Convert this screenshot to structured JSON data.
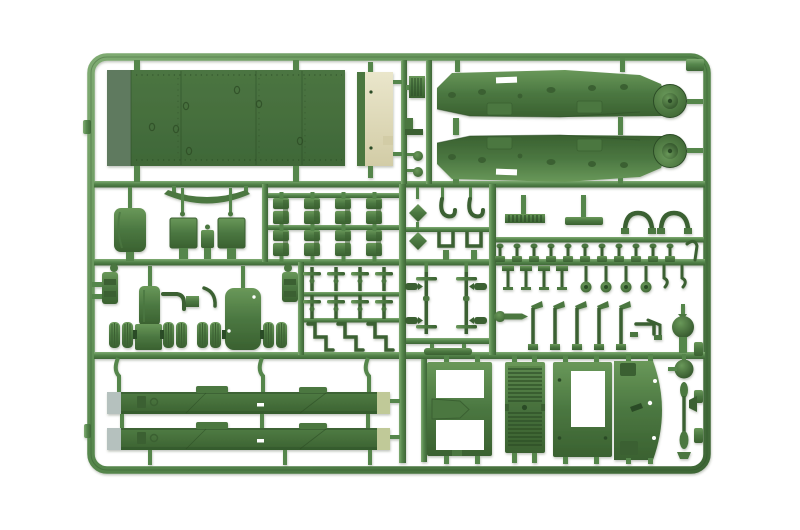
{
  "meta": {
    "description": "Photograph of a green injection-molded plastic model kit sprue with tank hull parts on a white background",
    "subject": "model-kit-sprue",
    "plastic_color_name": "olive green",
    "backdrop": "white seamless"
  },
  "colors": {
    "background": "#ffffff",
    "runner-light": "#7fab72",
    "runner-mid": "#55864c",
    "runner-dark": "#3e6636",
    "part-light": "#699859",
    "part-mid": "#4b7741",
    "part-dark": "#3a6130",
    "part-darker": "#2c4c25",
    "plate-light": "#4c7542",
    "plate-dark": "#3f6838",
    "plate-band": "#5e7a5e",
    "cream-light": "#eae6cb",
    "cream-dark": "#d2cca6",
    "beam-light": "#507c44",
    "beam-dark": "#3b6231",
    "beam-cap-left": "#b5c1be",
    "beam-cap-right": "#c0c998",
    "white-detail": "#ffffff"
  },
  "sprue": {
    "frame": {
      "x": 91,
      "y": 57,
      "width": 616,
      "height": 413,
      "corner_radius": 16
    },
    "sections": [
      {
        "id": "top-left",
        "label": "hull deck plate",
        "parts": [
          {
            "name": "large riveted deck plate"
          },
          {
            "name": "light unpigmented end strip"
          }
        ]
      },
      {
        "id": "top-right",
        "label": "fenders",
        "parts": [
          {
            "name": "track fender with round wheel housing",
            "count": 2
          },
          {
            "name": "small ribbed chip"
          },
          {
            "name": "l-bracket"
          },
          {
            "name": "round knob",
            "count": 2
          }
        ]
      },
      {
        "id": "middle-left",
        "label": "stowage fittings",
        "parts": [
          {
            "name": "curved leaf spring"
          },
          {
            "name": "rounded stowage box"
          },
          {
            "name": "square hatch plate",
            "count": 2
          },
          {
            "name": "small fitting"
          }
        ]
      },
      {
        "id": "bracket-grid",
        "label": "suspension brackets",
        "parts": [
          {
            "name": "small bracket",
            "count": 8
          }
        ]
      },
      {
        "id": "middle-center",
        "label": "clamps and hooks",
        "parts": [
          {
            "name": "diamond plate",
            "count": 2
          },
          {
            "name": "hook clamp",
            "count": 2
          },
          {
            "name": "u-bracket",
            "count": 2
          }
        ]
      },
      {
        "id": "middle-right",
        "label": "pins and handles",
        "parts": [
          {
            "name": "ribbed comb strip"
          },
          {
            "name": "flat bar"
          },
          {
            "name": "grab handle",
            "count": 2
          },
          {
            "name": "small pin",
            "count": 11
          },
          {
            "name": "bent pin"
          }
        ]
      },
      {
        "id": "suspension-band",
        "label": "running gear",
        "parts": [
          {
            "name": "wheel bogie assembly",
            "count": 2
          },
          {
            "name": "mounting bracket",
            "count": 2
          },
          {
            "name": "elbow pipe",
            "count": 2
          },
          {
            "name": "cross axle",
            "count": 8
          },
          {
            "name": "z-bracket",
            "count": 3
          },
          {
            "name": "long axle shaft with crossbars",
            "count": 2
          },
          {
            "name": "flat-foot pin",
            "count": 4
          },
          {
            "name": "disc-head pin",
            "count": 4
          },
          {
            "name": "hook pin",
            "count": 2
          },
          {
            "name": "rod with disc"
          },
          {
            "name": "hammer rod",
            "count": 5
          },
          {
            "name": "bent rod",
            "count": 2
          },
          {
            "name": "ball fitting"
          }
        ]
      },
      {
        "id": "bottom-left",
        "label": "hull side beams",
        "parts": [
          {
            "name": "long side beam with light ends",
            "count": 2
          }
        ]
      },
      {
        "id": "bottom-right",
        "label": "hull panels",
        "parts": [
          {
            "name": "frame panel with two cutouts"
          },
          {
            "name": "louvered grille panel"
          },
          {
            "name": "panel with rectangular opening"
          },
          {
            "name": "curved side panel"
          },
          {
            "name": "antenna rod with beads"
          },
          {
            "name": "ball cap"
          }
        ]
      }
    ]
  }
}
